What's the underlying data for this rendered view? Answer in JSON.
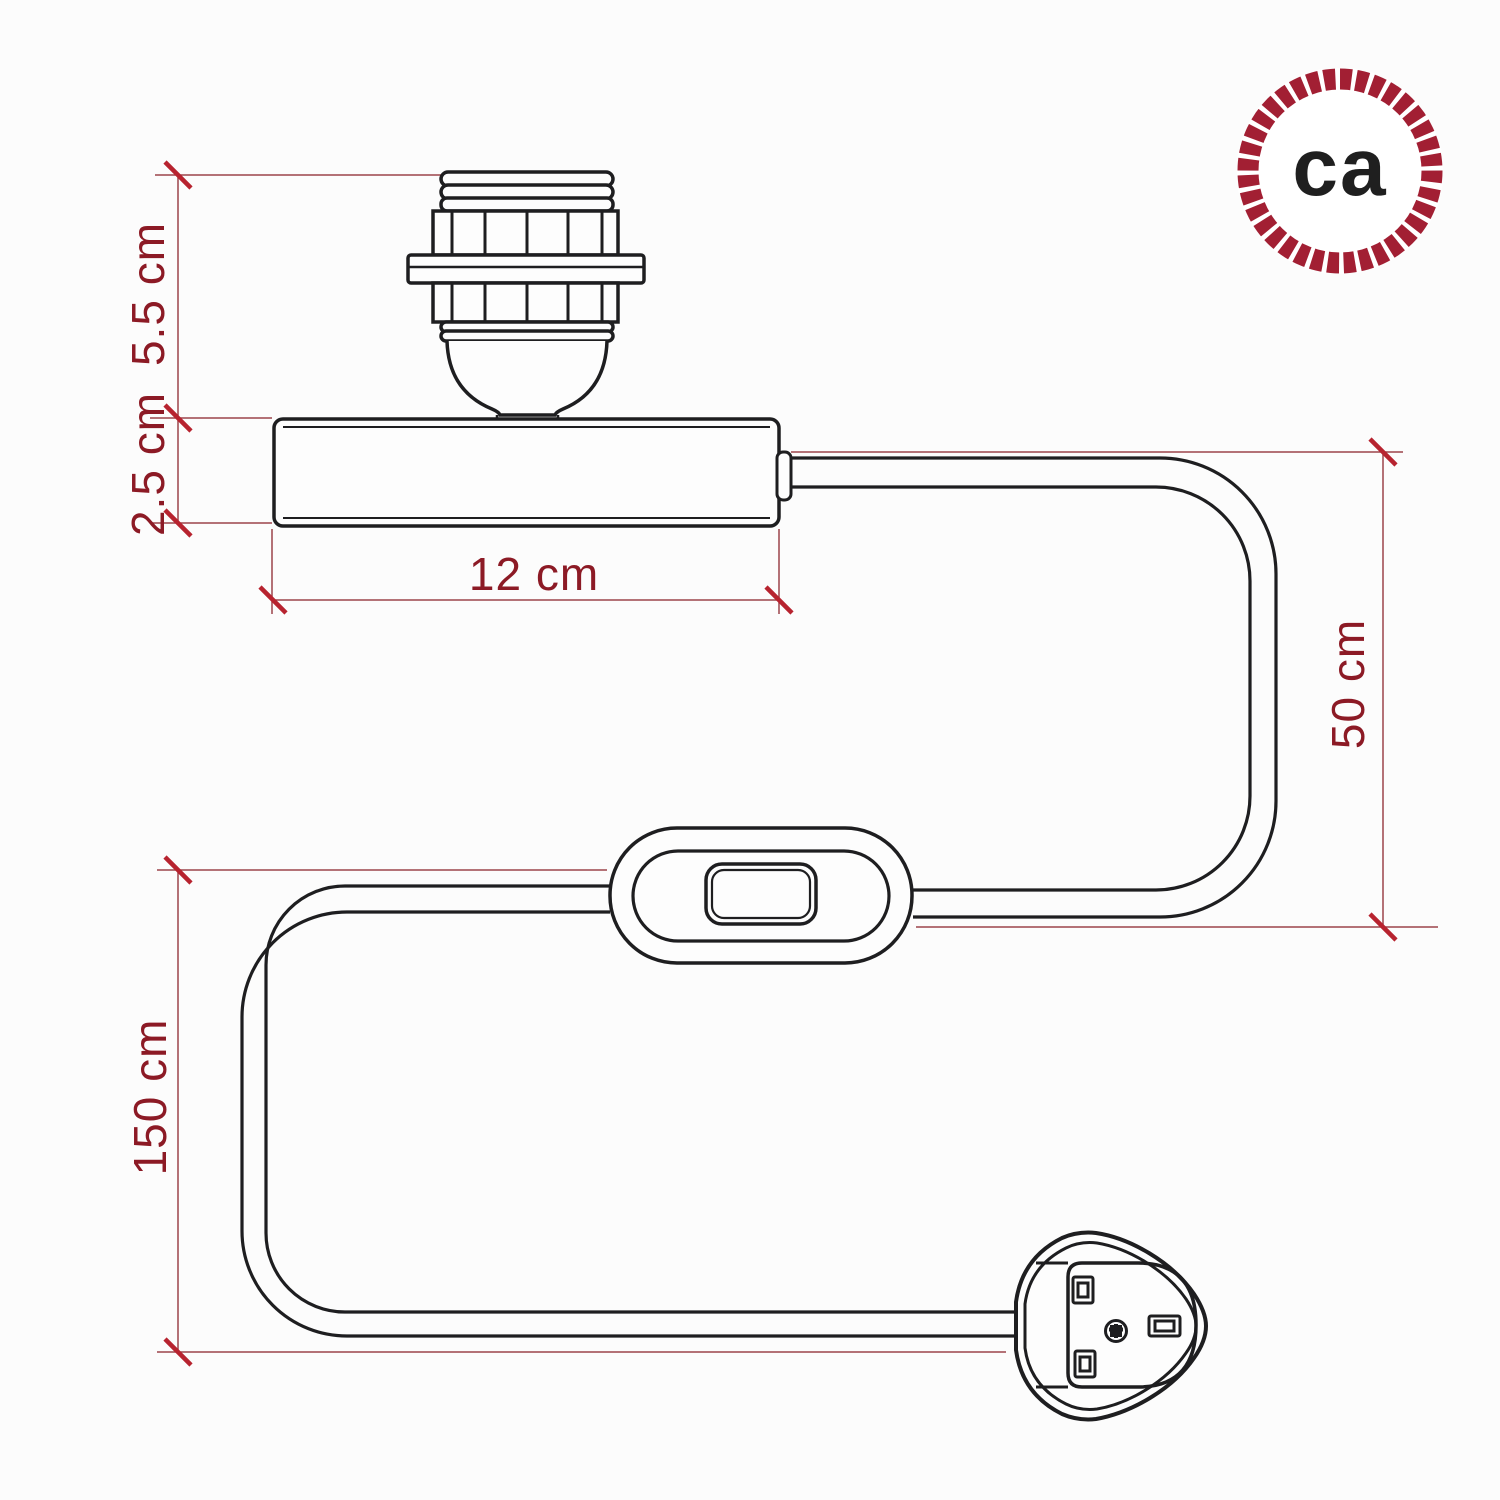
{
  "figure": {
    "kind": "product dimension diagram",
    "background": "#fcfcfc",
    "line_color": "#1e1e20",
    "dimension_text_color": "#8c1a25",
    "dimension_line_color": "#9c444b",
    "tick_color": "#b7232f"
  },
  "parts": {
    "lamp_holder": "E27 threaded lamp holder with shade ring",
    "base": "Cylindrical lamp base",
    "cable": "Power cable",
    "switch": "Inline rocker switch",
    "plug": "UK 3-pin plug"
  },
  "dimensions": {
    "socket_height": "5.5 cm",
    "base_height": "2.5 cm",
    "base_width": "12 cm",
    "base_to_switch": "50 cm",
    "switch_to_plug": "150 cm"
  },
  "logo": {
    "text": "ca",
    "ring_color": "#a21f33",
    "text_color": "#1f1f1f"
  }
}
